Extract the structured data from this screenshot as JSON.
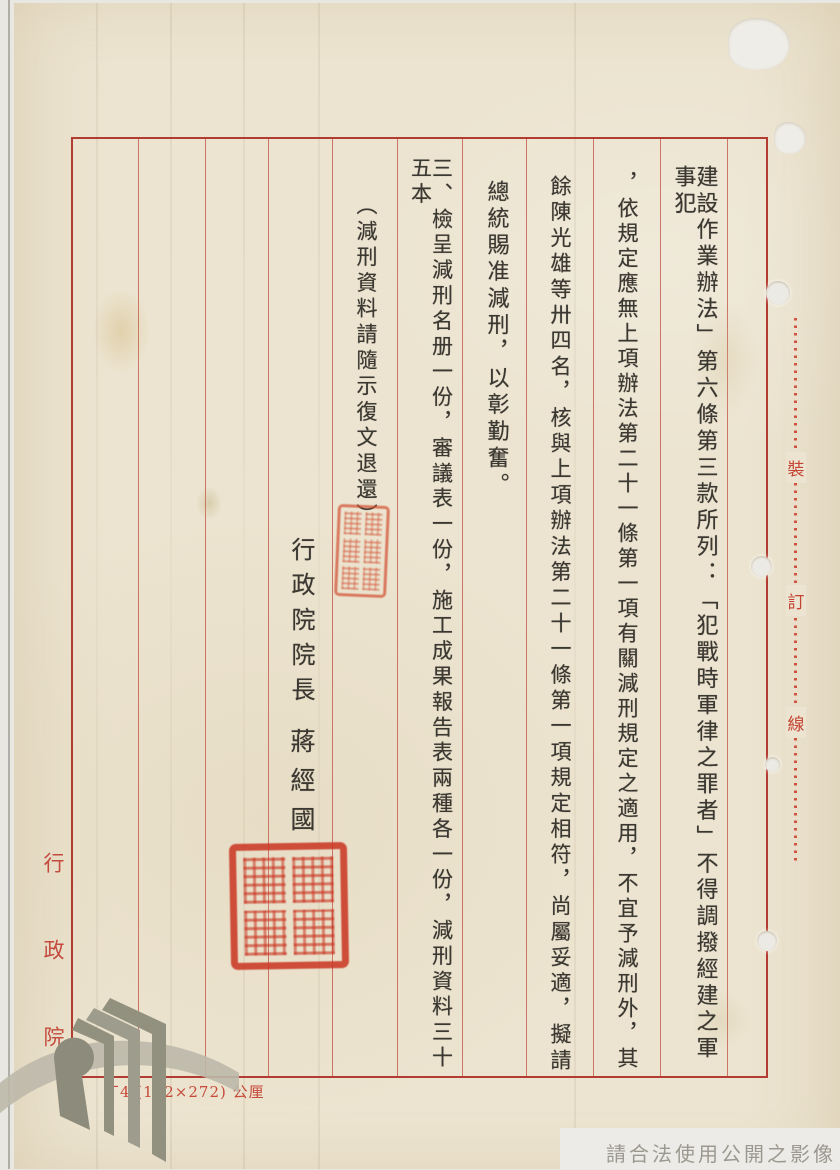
{
  "page": {
    "columns": [
      "建設作業辦法」第六條第三款所列：「犯戰時軍律之罪者」不得調撥經建之軍事犯",
      "，依規定應無上項辦法第二十一條第一項有關減刑規定之適用，不宜予減刑外，其",
      "餘陳光雄等卅四名，核與上項辦法第二十一條第一項規定相符，尚屬妥適，擬請",
      "總統賜准減刑，以彰勤奮。",
      "三、檢呈減刑名册一份，審議表一份，施工成果報告表兩種各一份，減刑資料三十五本",
      "（減刑資料請隨示復文退還）"
    ],
    "signature": {
      "title": "行政院院長",
      "name": "蔣經國"
    },
    "margin": {
      "binding_chars": [
        "裝",
        "訂",
        "線"
      ],
      "left_label": "行政院",
      "footer_note": "丁4 (192×272) 公厘",
      "watermark": "請合法使用公開之影像"
    },
    "colors": {
      "paper": "#ece4d0",
      "grid_red": "#b23c31",
      "ink": "#3b3832",
      "stamp_red": "#cc4430",
      "margin_red": "#c34a3c",
      "watermark_gray": "#9b998f"
    }
  }
}
